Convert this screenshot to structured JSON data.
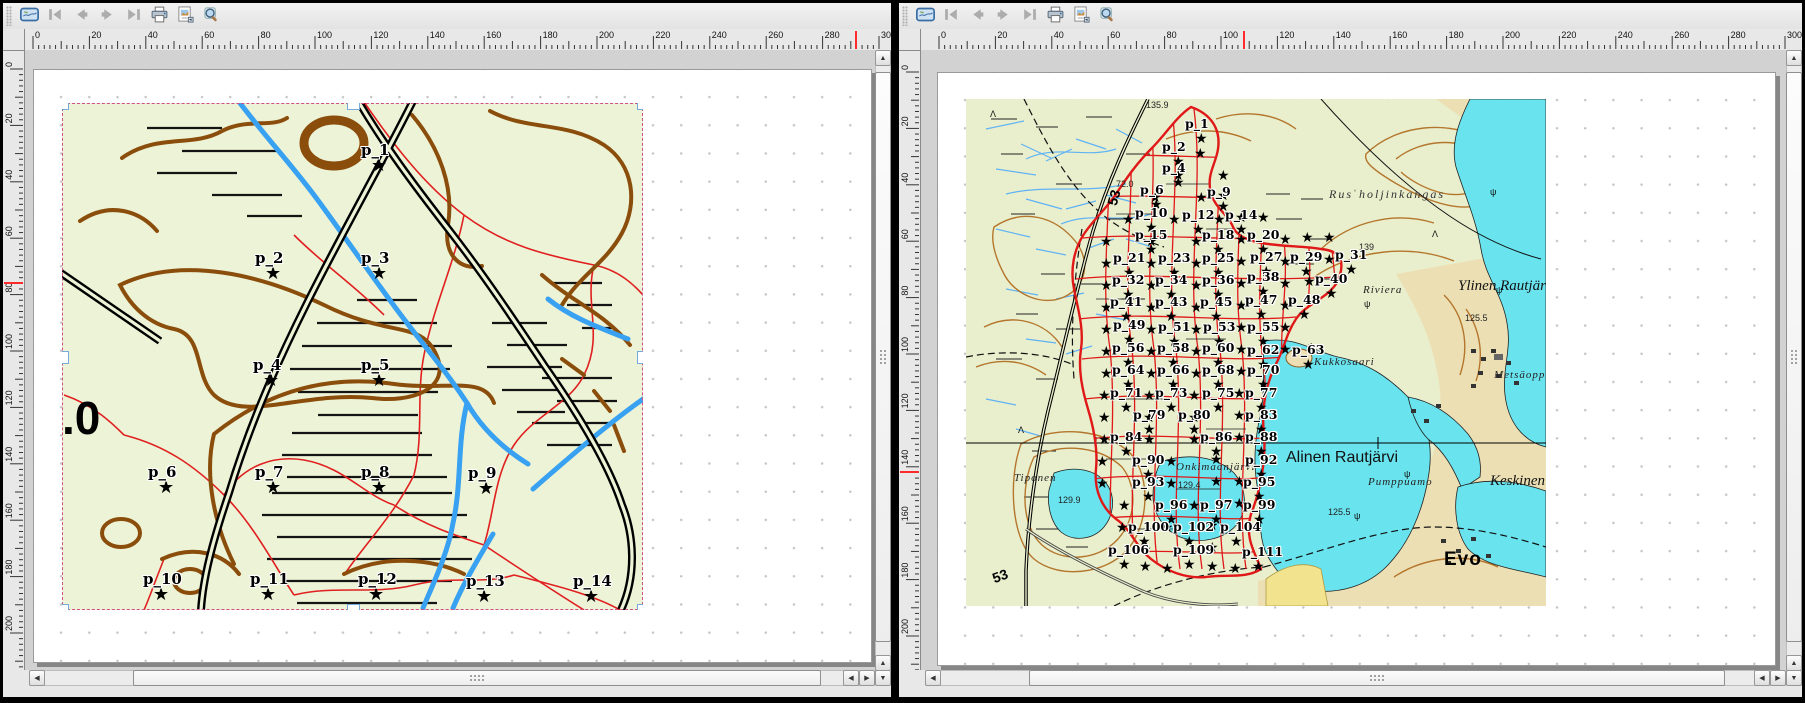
{
  "palette": {
    "cursor_mark": "#ff2a2a",
    "selection_dash": "#cf4f86",
    "handle_border": "#74aadc",
    "page_bg": "#ffffff",
    "canvas_bg": "#d2d2d2",
    "chrome_bg": "#e8e8e8",
    "map_bg_left": "#edf3d6",
    "map_bg_right": "#e9efcd",
    "lake": "#69e4ef",
    "tan_terrain": "#ecdfb4",
    "contour_dark": "#8a4d0b",
    "contour_light": "#b4762c",
    "stream_blue": "#38a1f1",
    "marsh_blue": "#5fb2f5",
    "red_line": "#e02020",
    "sample_region_red": "#e01818",
    "road_black": "#000000"
  },
  "toolbar": {
    "buttons": [
      {
        "icon": "atlas-preview-icon",
        "enabled": true
      },
      {
        "icon": "first-feature-icon",
        "enabled": false
      },
      {
        "icon": "previous-feature-icon",
        "enabled": false
      },
      {
        "icon": "next-feature-icon",
        "enabled": false
      },
      {
        "icon": "last-feature-icon",
        "enabled": false
      },
      {
        "icon": "print-icon",
        "enabled": true
      },
      {
        "icon": "export-image-icon",
        "enabled": true
      },
      {
        "icon": "zoom-settings-icon",
        "enabled": true
      }
    ]
  },
  "panels": [
    {
      "name": "left-composer",
      "h_ruler": {
        "origin_px": 30,
        "px_per_unit": 2.82,
        "max_unit": 300,
        "label_step": 20,
        "cursor_px": 853,
        "labels": [
          0,
          20,
          40,
          60,
          80,
          100,
          120,
          140,
          160,
          180,
          200,
          220,
          240,
          260,
          280,
          300
        ]
      },
      "v_ruler": {
        "origin_px": 66,
        "px_per_unit": 2.82,
        "max_unit": 212,
        "label_step": 20,
        "cursor_px": 280,
        "labels": [
          0,
          20,
          40,
          60,
          80,
          100,
          120,
          140,
          160,
          180,
          200
        ]
      },
      "map_item": {
        "selected": true,
        "texts": [
          {
            "t": ".0",
            "x": 0,
            "y": 288,
            "c": "huge-elev"
          }
        ],
        "points": [
          {
            "l": "p_1",
            "x": 318,
            "y": 64
          },
          {
            "l": "p_2",
            "x": 212,
            "y": 172
          },
          {
            "l": "p_3",
            "x": 318,
            "y": 172
          },
          {
            "l": "p_4",
            "x": 210,
            "y": 279
          },
          {
            "l": "p_5",
            "x": 318,
            "y": 279
          },
          {
            "l": "p_6",
            "x": 105,
            "y": 386
          },
          {
            "l": "p_7",
            "x": 212,
            "y": 386
          },
          {
            "l": "p_8",
            "x": 318,
            "y": 386
          },
          {
            "l": "p_9",
            "x": 425,
            "y": 387
          },
          {
            "l": "p_10",
            "x": 100,
            "y": 493
          },
          {
            "l": "p_11",
            "x": 207,
            "y": 493
          },
          {
            "l": "p_12",
            "x": 315,
            "y": 493
          },
          {
            "l": "p_13",
            "x": 423,
            "y": 495
          },
          {
            "l": "p_14",
            "x": 530,
            "y": 495
          }
        ],
        "extra_stars": []
      }
    },
    {
      "name": "right-composer",
      "h_ruler": {
        "origin_px": 40,
        "px_per_unit": 2.82,
        "max_unit": 300,
        "label_step": 20,
        "cursor_px": 345,
        "labels": [
          0,
          20,
          40,
          60,
          80,
          100,
          120,
          140,
          160,
          180,
          200,
          220,
          240,
          260,
          280,
          300
        ]
      },
      "v_ruler": {
        "origin_px": 69,
        "px_per_unit": 2.82,
        "max_unit": 212,
        "label_step": 20,
        "cursor_px": 469,
        "labels": [
          0,
          20,
          40,
          60,
          80,
          100,
          120,
          140,
          160,
          180,
          200
        ]
      },
      "map_item": {
        "selected": false,
        "texts": [
          {
            "t": "135.9",
            "x": 180,
            "y": 1,
            "c": "elev"
          },
          {
            "t": "72.0",
            "x": 150,
            "y": 80,
            "c": "elev"
          },
          {
            "t": "53",
            "x": 138,
            "y": 104,
            "c": "roadnum",
            "rot": -75
          },
          {
            "t": "Rusˈholjinkangas",
            "x": 363,
            "y": 88,
            "c": "terrain"
          },
          {
            "t": "139",
            "x": 393,
            "y": 143,
            "c": "elev"
          },
          {
            "t": "Riviera",
            "x": 397,
            "y": 185,
            "c": "name-sm"
          },
          {
            "t": "Ylinen Rautjärvi",
            "x": 492,
            "y": 179,
            "c": "lake-big"
          },
          {
            "t": "125.5",
            "x": 499,
            "y": 214,
            "c": "elev"
          },
          {
            "t": "Kukkosaari",
            "x": 348,
            "y": 257,
            "c": "name-sm"
          },
          {
            "t": "Metsäoppilaitos",
            "x": 528,
            "y": 270,
            "c": "name-sm"
          },
          {
            "t": "Alinen Rautjärvi",
            "x": 320,
            "y": 350,
            "c": "lake-big2"
          },
          {
            "t": "Onkimaanjärvi",
            "x": 210,
            "y": 362,
            "c": "name-sm"
          },
          {
            "t": "129.4",
            "x": 212,
            "y": 381,
            "c": "elev"
          },
          {
            "t": "Pumppuamo",
            "x": 402,
            "y": 377,
            "c": "name-sm"
          },
          {
            "t": "Keskinen",
            "x": 524,
            "y": 374,
            "c": "lake-big"
          },
          {
            "t": "Tiponen",
            "x": 48,
            "y": 373,
            "c": "name-sm"
          },
          {
            "t": "129.9",
            "x": 92,
            "y": 396,
            "c": "elev"
          },
          {
            "t": "125.5",
            "x": 362,
            "y": 408,
            "c": "elev"
          },
          {
            "t": "Evo",
            "x": 478,
            "y": 450,
            "c": "place-big"
          },
          {
            "t": "53",
            "x": 24,
            "y": 472,
            "c": "roadnum",
            "rot": -20
          },
          {
            "t": "Λ",
            "x": 24,
            "y": 10,
            "c": "sym"
          },
          {
            "t": "Λ",
            "x": 466,
            "y": 130,
            "c": "sym"
          },
          {
            "t": "Λ",
            "x": 52,
            "y": 326,
            "c": "sym"
          },
          {
            "t": "ψ",
            "x": 398,
            "y": 200,
            "c": "sym"
          },
          {
            "t": "ψ",
            "x": 342,
            "y": 242,
            "c": "sym"
          },
          {
            "t": "ψ",
            "x": 524,
            "y": 88,
            "c": "sym"
          },
          {
            "t": "ψ",
            "x": 530,
            "y": 186,
            "c": "sym"
          },
          {
            "t": "ψ",
            "x": 388,
            "y": 412,
            "c": "sym"
          },
          {
            "t": "ψ",
            "x": 438,
            "y": 370,
            "c": "sym"
          }
        ],
        "points": [
          {
            "l": "p_1",
            "x": 236,
            "y": 40
          },
          {
            "l": "p_2",
            "x": 213,
            "y": 63
          },
          {
            "l": "p_4",
            "x": 213,
            "y": 84
          },
          {
            "l": "p_6",
            "x": 191,
            "y": 106
          },
          {
            "l": "p_9",
            "x": 258,
            "y": 108
          },
          {
            "l": "p_10",
            "x": 186,
            "y": 129
          },
          {
            "l": "p_12",
            "x": 233,
            "y": 131
          },
          {
            "l": "p_14",
            "x": 276,
            "y": 131
          },
          {
            "l": "p_15",
            "x": 186,
            "y": 151
          },
          {
            "l": "p_18",
            "x": 253,
            "y": 151
          },
          {
            "l": "p_20",
            "x": 298,
            "y": 151
          },
          {
            "l": "p_21",
            "x": 164,
            "y": 174
          },
          {
            "l": "p_23",
            "x": 209,
            "y": 174
          },
          {
            "l": "p_25",
            "x": 253,
            "y": 174
          },
          {
            "l": "p_27",
            "x": 301,
            "y": 173
          },
          {
            "l": "p_29",
            "x": 341,
            "y": 173
          },
          {
            "l": "p_31",
            "x": 386,
            "y": 171
          },
          {
            "l": "p_32",
            "x": 163,
            "y": 196
          },
          {
            "l": "p_34",
            "x": 206,
            "y": 196
          },
          {
            "l": "p_36",
            "x": 253,
            "y": 196
          },
          {
            "l": "p_38",
            "x": 298,
            "y": 193
          },
          {
            "l": "p_40",
            "x": 366,
            "y": 195
          },
          {
            "l": "p_41",
            "x": 161,
            "y": 218
          },
          {
            "l": "p_43",
            "x": 206,
            "y": 218
          },
          {
            "l": "p_45",
            "x": 251,
            "y": 218
          },
          {
            "l": "p_47",
            "x": 296,
            "y": 216
          },
          {
            "l": "p_48",
            "x": 339,
            "y": 216
          },
          {
            "l": "p_49",
            "x": 164,
            "y": 241
          },
          {
            "l": "p_51",
            "x": 209,
            "y": 243
          },
          {
            "l": "p_53",
            "x": 254,
            "y": 243
          },
          {
            "l": "p_55",
            "x": 298,
            "y": 243
          },
          {
            "l": "p_56",
            "x": 163,
            "y": 264
          },
          {
            "l": "p_58",
            "x": 208,
            "y": 264
          },
          {
            "l": "p_60",
            "x": 253,
            "y": 264
          },
          {
            "l": "p_62",
            "x": 298,
            "y": 266
          },
          {
            "l": "p_63",
            "x": 343,
            "y": 266
          },
          {
            "l": "p_64",
            "x": 163,
            "y": 286
          },
          {
            "l": "p_66",
            "x": 208,
            "y": 286
          },
          {
            "l": "p_68",
            "x": 253,
            "y": 286
          },
          {
            "l": "p_70",
            "x": 298,
            "y": 286
          },
          {
            "l": "p_71",
            "x": 161,
            "y": 309
          },
          {
            "l": "p_73",
            "x": 206,
            "y": 309
          },
          {
            "l": "p_75",
            "x": 253,
            "y": 309
          },
          {
            "l": "p_77",
            "x": 296,
            "y": 309
          },
          {
            "l": "p_79",
            "x": 184,
            "y": 331
          },
          {
            "l": "p_80",
            "x": 229,
            "y": 331
          },
          {
            "l": "p_83",
            "x": 296,
            "y": 331
          },
          {
            "l": "p_84",
            "x": 161,
            "y": 353
          },
          {
            "l": "p_86",
            "x": 251,
            "y": 353
          },
          {
            "l": "p_88",
            "x": 296,
            "y": 353
          },
          {
            "l": "p_90",
            "x": 183,
            "y": 376
          },
          {
            "l": "p_92",
            "x": 296,
            "y": 376
          },
          {
            "l": "p_93",
            "x": 183,
            "y": 398
          },
          {
            "l": "p_95",
            "x": 294,
            "y": 398
          },
          {
            "l": "p_96",
            "x": 206,
            "y": 421
          },
          {
            "l": "p_97",
            "x": 251,
            "y": 421
          },
          {
            "l": "p_99",
            "x": 294,
            "y": 421
          },
          {
            "l": "p_100",
            "x": 179,
            "y": 443
          },
          {
            "l": "p_102",
            "x": 224,
            "y": 443
          },
          {
            "l": "p_104",
            "x": 271,
            "y": 443
          },
          {
            "l": "p_106",
            "x": 159,
            "y": 466
          },
          {
            "l": "p_109",
            "x": 224,
            "y": 466
          },
          {
            "l": "p_111",
            "x": 293,
            "y": 468
          }
        ],
        "extra_stars": [
          [
            235,
            55
          ],
          [
            213,
            77
          ],
          [
            258,
            77
          ],
          [
            190,
            99
          ],
          [
            236,
            99
          ],
          [
            258,
            97
          ],
          [
            163,
            121
          ],
          [
            209,
            121
          ],
          [
            254,
            121
          ],
          [
            276,
            119
          ],
          [
            298,
            119
          ],
          [
            141,
            143
          ],
          [
            186,
            143
          ],
          [
            231,
            143
          ],
          [
            276,
            141
          ],
          [
            320,
            141
          ],
          [
            342,
            139
          ],
          [
            364,
            139
          ],
          [
            141,
            165
          ],
          [
            186,
            165
          ],
          [
            231,
            165
          ],
          [
            276,
            163
          ],
          [
            320,
            163
          ],
          [
            364,
            161
          ],
          [
            141,
            187
          ],
          [
            186,
            187
          ],
          [
            231,
            187
          ],
          [
            276,
            185
          ],
          [
            320,
            185
          ],
          [
            344,
            183
          ],
          [
            141,
            209
          ],
          [
            186,
            209
          ],
          [
            231,
            209
          ],
          [
            276,
            207
          ],
          [
            320,
            207
          ],
          [
            141,
            231
          ],
          [
            186,
            231
          ],
          [
            231,
            231
          ],
          [
            276,
            229
          ],
          [
            320,
            229
          ],
          [
            141,
            253
          ],
          [
            186,
            253
          ],
          [
            231,
            253
          ],
          [
            276,
            251
          ],
          [
            320,
            251
          ],
          [
            141,
            275
          ],
          [
            186,
            275
          ],
          [
            231,
            275
          ],
          [
            276,
            273
          ],
          [
            139,
            297
          ],
          [
            184,
            297
          ],
          [
            229,
            297
          ],
          [
            274,
            295
          ],
          [
            139,
            319
          ],
          [
            184,
            319
          ],
          [
            229,
            319
          ],
          [
            274,
            317
          ],
          [
            139,
            341
          ],
          [
            184,
            341
          ],
          [
            229,
            341
          ],
          [
            274,
            339
          ],
          [
            137,
            363
          ],
          [
            206,
            363
          ],
          [
            251,
            361
          ],
          [
            137,
            385
          ],
          [
            206,
            385
          ],
          [
            251,
            383
          ],
          [
            274,
            383
          ],
          [
            159,
            407
          ],
          [
            229,
            407
          ],
          [
            274,
            405
          ],
          [
            157,
            429
          ],
          [
            202,
            429
          ],
          [
            247,
            427
          ],
          [
            180,
            451
          ],
          [
            247,
            449
          ],
          [
            180,
            468
          ],
          [
            202,
            470
          ],
          [
            247,
            468
          ],
          [
            270,
            470
          ]
        ]
      }
    }
  ]
}
